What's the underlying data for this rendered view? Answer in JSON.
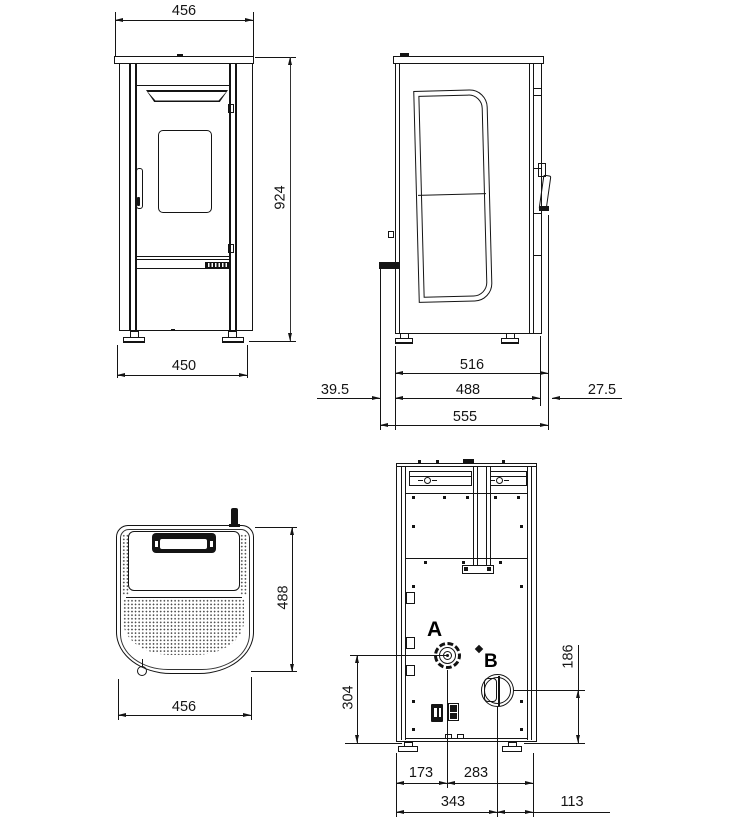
{
  "drawing_title": "Stove dimensional drawing (front, side, top, rear views)",
  "ports": {
    "a": "A",
    "b": "B"
  },
  "dims": {
    "front": {
      "width_top": "456",
      "height": "924",
      "base_width": "450"
    },
    "side": {
      "depth_to_handle": "516",
      "body_depth": "488",
      "rear_offset": "39.5",
      "front_offset": "27.5",
      "overall_depth": "555"
    },
    "top": {
      "depth": "488",
      "width": "456"
    },
    "rear": {
      "left_to_a": "173",
      "a_to_right": "283",
      "left_to_b": "343",
      "b_to_right": "113",
      "a_center_height": "304",
      "b_center_height": "186"
    }
  }
}
